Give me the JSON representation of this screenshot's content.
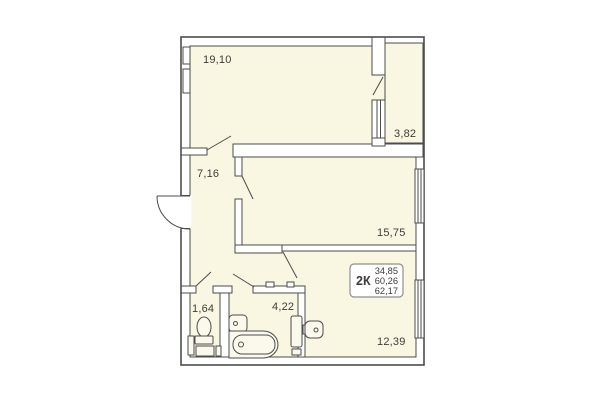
{
  "plan": {
    "kind": "apartment-floor-plan",
    "rooms": {
      "living_room": {
        "area": "19,10"
      },
      "balcony": {
        "area": "3,82"
      },
      "hallway": {
        "area": "7,16"
      },
      "bedroom": {
        "area": "15,75"
      },
      "wc": {
        "area": "1,64"
      },
      "bathroom": {
        "area": "4,22"
      },
      "kitchen": {
        "area": "12,39"
      }
    },
    "summary": {
      "type_label": "2К",
      "living_area": "34,85",
      "total_area": "60,26",
      "total_area_with_balcony": "62,17"
    }
  },
  "colors": {
    "floor_fill": "#f9f6e1",
    "wall_stroke": "#4c4c4c",
    "fixture_fill": "#fbf9ec",
    "text_color": "#3d3d3d",
    "info_box_border": "#8f8f8f"
  }
}
